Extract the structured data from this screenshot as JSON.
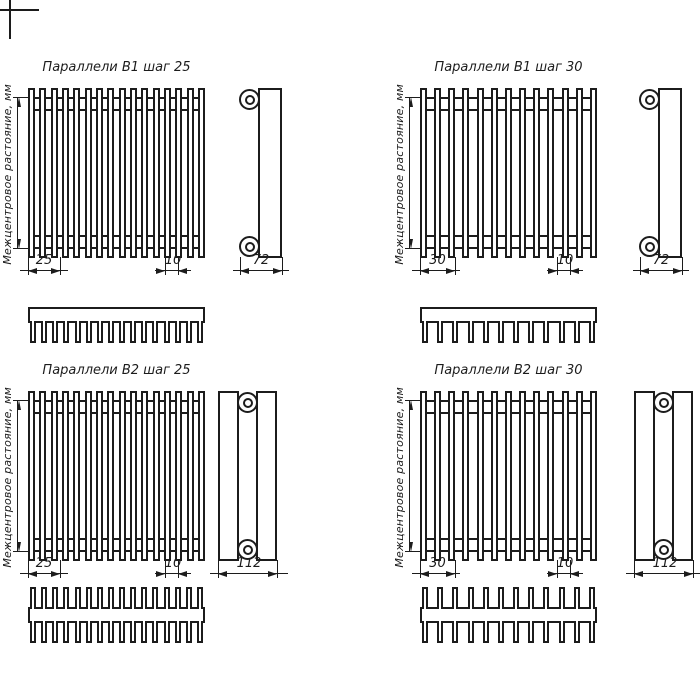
{
  "page": {
    "background": "#ffffff",
    "line_color": "#1c1c1c"
  },
  "axis_label": "Межцентровое растояние, мм",
  "quadrants": [
    {
      "title": "Параллели В1 шаг 25",
      "pitch": "25",
      "end_gap": "10",
      "depth": "72",
      "tubes": 16,
      "teeth": 16
    },
    {
      "title": "Параллели В1 шаг 30",
      "pitch": "30",
      "end_gap": "10",
      "depth": "72",
      "tubes": 13,
      "teeth": 12
    },
    {
      "title": "Параллели В2 шаг 25",
      "pitch": "25",
      "end_gap": "10",
      "depth": "112",
      "tubes": 16,
      "teeth": 16
    },
    {
      "title": "Параллели В2 шаг 30",
      "pitch": "30",
      "end_gap": "10",
      "depth": "112",
      "tubes": 13,
      "teeth": 12
    }
  ]
}
